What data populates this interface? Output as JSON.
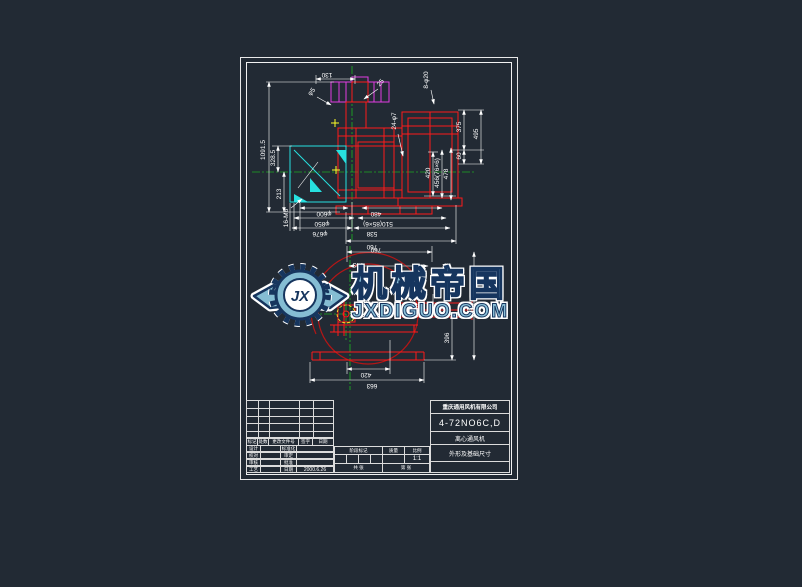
{
  "watermark": {
    "initials": "JX",
    "title": "机械帝国",
    "subtitle": "JXDIGUO.COM"
  },
  "title_block": {
    "company": "重庆通用风机有限公司",
    "model": "4-72NO6C,D",
    "product": "离心通风机",
    "doc_title": "外形及基础尺寸",
    "header": [
      "标记",
      "处数",
      "更改文件号",
      "签字",
      "日期"
    ],
    "rows": [
      {
        "label": "设计",
        "label2": "标准化",
        "value": ""
      },
      {
        "label": "校对",
        "label2": "审定",
        "value": ""
      },
      {
        "label": "审核",
        "label2": "批准",
        "value": ""
      },
      {
        "label": "工艺",
        "label2": "日期",
        "value": "2000.6.26"
      }
    ],
    "stage_label": "阶段标记",
    "weight_label": "质量",
    "scale_label": "比例",
    "scale_value": "1:1",
    "sheet_total": "共 张",
    "sheet_no": "第 张"
  },
  "dims": {
    "d130": "130",
    "dphi5": "φ5",
    "d25": "25",
    "d24phi7": "24-φ7",
    "d8phi20": "8-φ20",
    "d1091": "1091.5",
    "d328": "328.5",
    "d213": "213",
    "d16m6": "16-M6",
    "dphi600": "φ600",
    "dphi850": "φ850",
    "dphi676": "φ676",
    "d480": "480",
    "d510": "510(85×6)",
    "d538": "538",
    "d760t": "760",
    "d375": "375",
    "d60": "60",
    "d495": "495",
    "d420r": "420",
    "d456": "456(76×6)",
    "d478": "478",
    "d760f": "760",
    "d743": "743",
    "d396": "396",
    "d420b": "420",
    "d663": "663"
  }
}
